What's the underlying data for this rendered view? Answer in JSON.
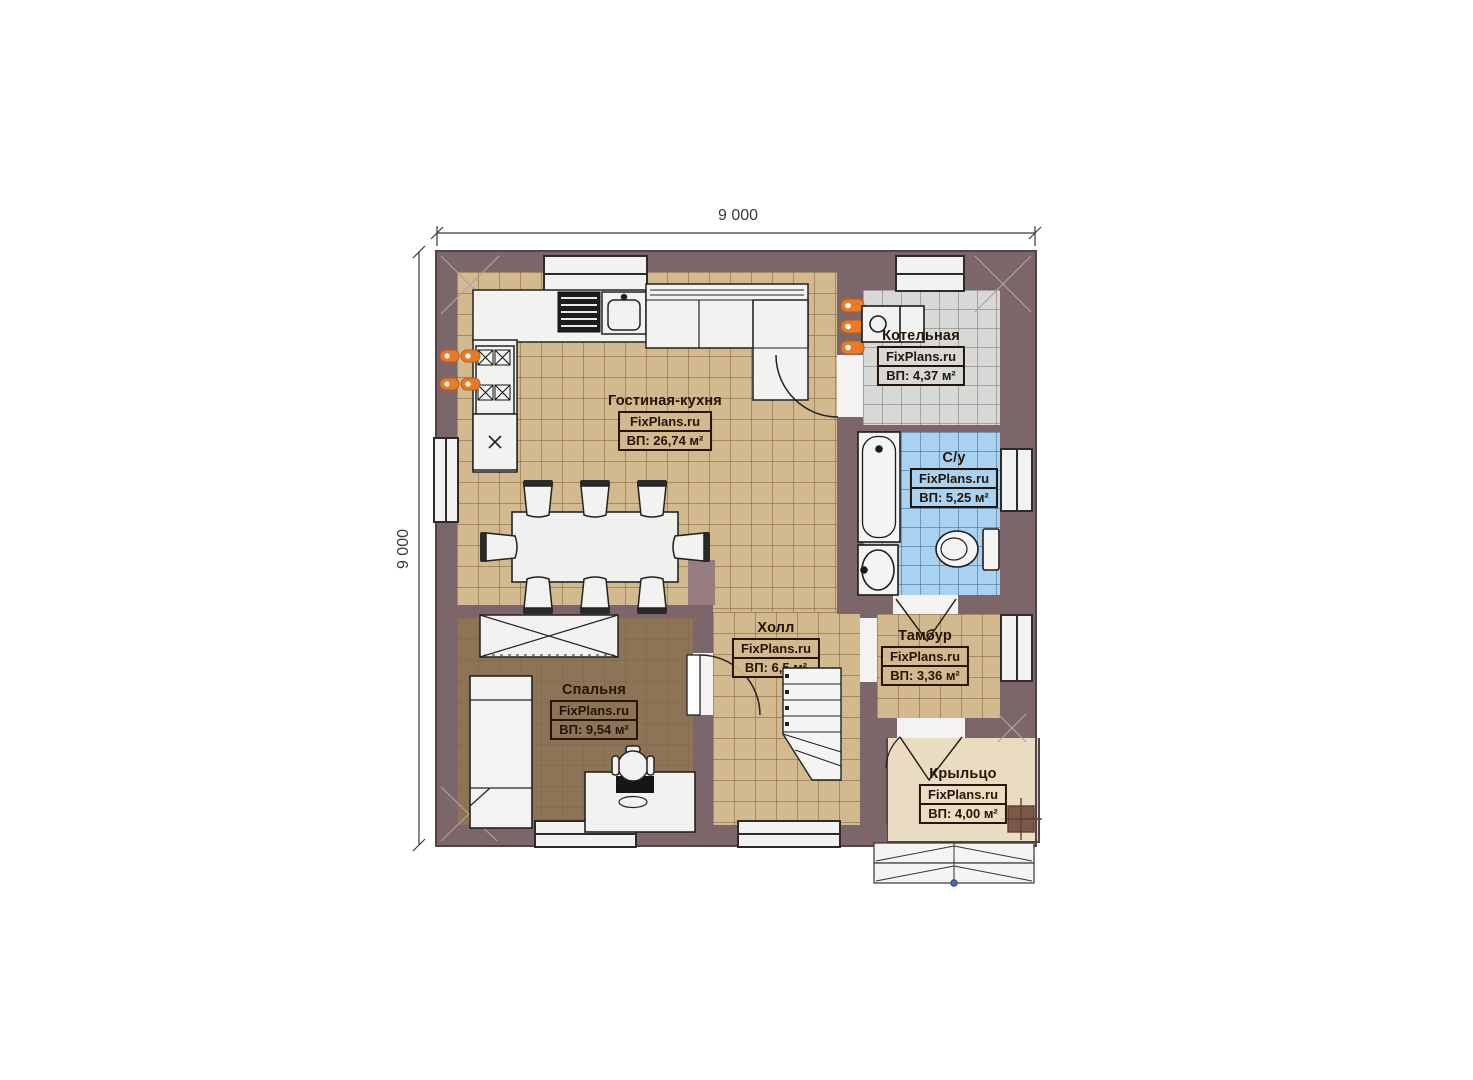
{
  "page": {
    "background": "#ffffff",
    "type": "floor-plan"
  },
  "dimensions": {
    "top": "9 000",
    "left": "9 000"
  },
  "rooms": [
    {
      "id": "living-kitchen",
      "name": "Гостиная-кухня",
      "brand": "FixPlans.ru",
      "area": "ВП: 26,74 м²"
    },
    {
      "id": "boiler-room",
      "name": "Котельная",
      "brand": "FixPlans.ru",
      "area": "ВП: 4,37 м²"
    },
    {
      "id": "bathroom",
      "name": "С/у",
      "brand": "FixPlans.ru",
      "area": "ВП: 5,25 м²"
    },
    {
      "id": "hall",
      "name": "Холл",
      "brand": "FixPlans.ru",
      "area": "ВП: 6,5 м²"
    },
    {
      "id": "vestibule",
      "name": "Тамбур",
      "brand": "FixPlans.ru",
      "area": "ВП: 3,36 м²"
    },
    {
      "id": "bedroom",
      "name": "Спальня",
      "brand": "FixPlans.ru",
      "area": "ВП: 9,54 м²"
    },
    {
      "id": "porch",
      "name": "Крыльцо",
      "brand": "FixPlans.ru",
      "area": "ВП: 4,00 м²"
    }
  ],
  "colors": {
    "wall": "#7c6669",
    "floor_tile_beige": "#d3b98e",
    "floor_bedroom": "#8e7457",
    "floor_boiler": "#d8d8d6",
    "floor_bathroom": "#a9d2f0",
    "floor_porch": "#e9dcc1",
    "radiator_orange": "#e87a28",
    "line": "#222222"
  }
}
